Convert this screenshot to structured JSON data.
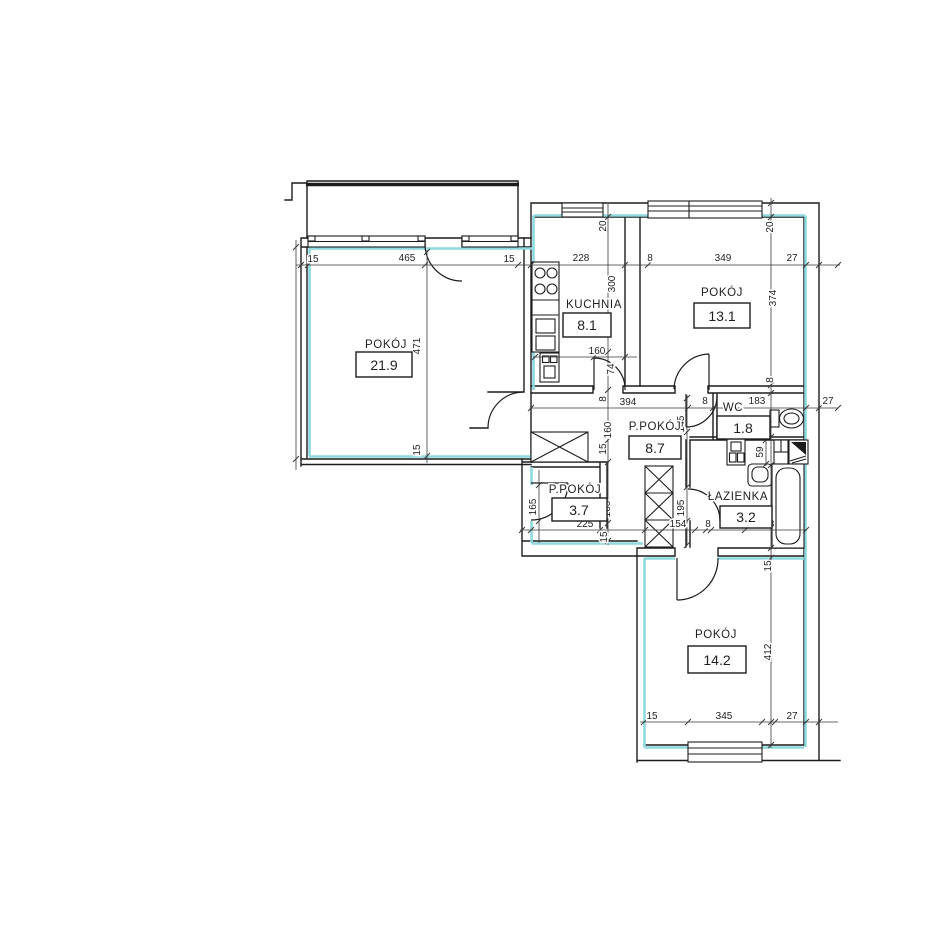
{
  "plan_type": "apartment-floor-plan",
  "rooms": [
    {
      "label": "POKÓJ",
      "area": "21.9"
    },
    {
      "label": "KUCHNIA",
      "area": "8.1"
    },
    {
      "label": "POKÓJ",
      "area": "13.1"
    },
    {
      "label": "P.POKÓJ",
      "area": "8.7"
    },
    {
      "label": "WC",
      "area": "1.8"
    },
    {
      "label": "ŁAZIENKA",
      "area": "3.2"
    },
    {
      "label": "P.POKÓJ",
      "area": "3.7"
    },
    {
      "label": "POKÓJ",
      "area": "14.2"
    }
  ],
  "dims": [
    "15",
    "465",
    "15",
    "228",
    "8",
    "349",
    "27",
    "20",
    "20",
    "300",
    "471",
    "374",
    "160",
    "74",
    "8",
    "394",
    "8",
    "145",
    "8",
    "183",
    "27",
    "160",
    "15",
    "15",
    "59",
    "165",
    "165",
    "195",
    "225",
    "15",
    "154",
    "8",
    "183",
    "15",
    "412",
    "15",
    "345",
    "27"
  ],
  "colors": {
    "wall": "#1c1c1c",
    "highlight": "#8ed9de",
    "dimension": "#3a3a3a",
    "background": "#ffffff"
  },
  "icons": [
    "stove-icon",
    "kitchen-sink-icon",
    "boiler-icon",
    "toilet-icon",
    "pedestal-sink-icon",
    "washbasin-icon",
    "washing-machine-icon",
    "bathtub-icon",
    "wardrobe-shaft-icon",
    "duct-shaft-icon",
    "window-icon",
    "door-arc-icon",
    "balcony"
  ]
}
